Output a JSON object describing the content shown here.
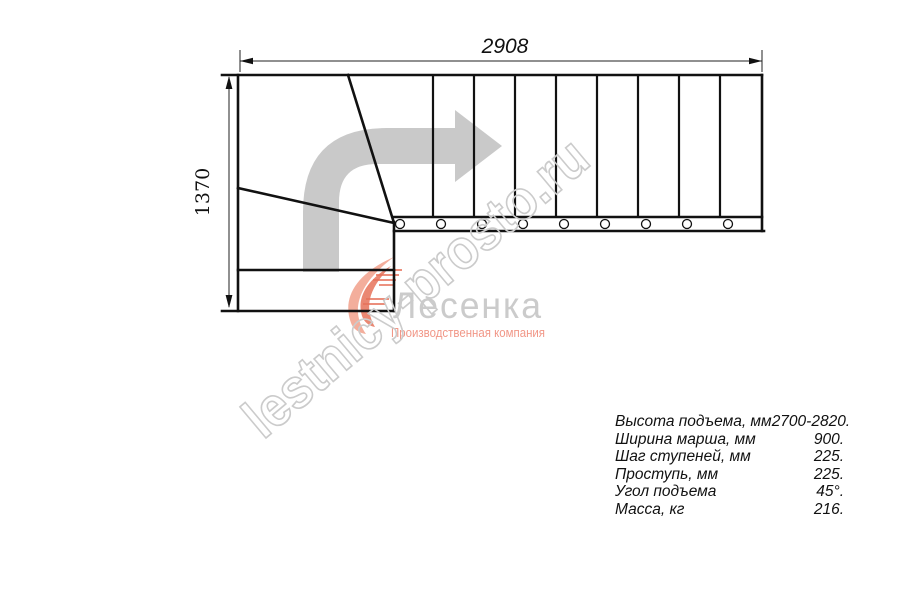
{
  "drawing": {
    "dim_top": "2908",
    "dim_left": "1370",
    "description": "staircase-plan-with-quarter-turn"
  },
  "direction_arrow": {
    "icon": "turn-right-arrow-icon"
  },
  "logo": {
    "name": "Лесенка",
    "tagline": "Производственная компания",
    "icon": "flame-swoosh-icon"
  },
  "watermark": "lestnicy-prosto.ru",
  "specs": {
    "rows": [
      {
        "label": "Высота подъема, мм",
        "value": "2700-2820."
      },
      {
        "label": "Ширина марша, мм",
        "value": "900."
      },
      {
        "label": "Шаг ступеней, мм",
        "value": "225."
      },
      {
        "label": "Проступь, мм",
        "value": "225."
      },
      {
        "label": "Угол подъема",
        "value": "45°."
      },
      {
        "label": "Масса, кг",
        "value": "216."
      }
    ]
  },
  "colors": {
    "line": "#111111",
    "dim_line": "#222222",
    "arrow_gray": "#c9c9c9",
    "watermark_gray": "#cbcbcb",
    "logo_name_gray": "#c2c2c2",
    "logo_flame_light": "#f2a08b",
    "logo_flame_dark": "#e2593c",
    "tagline_salmon": "#ef8573"
  }
}
